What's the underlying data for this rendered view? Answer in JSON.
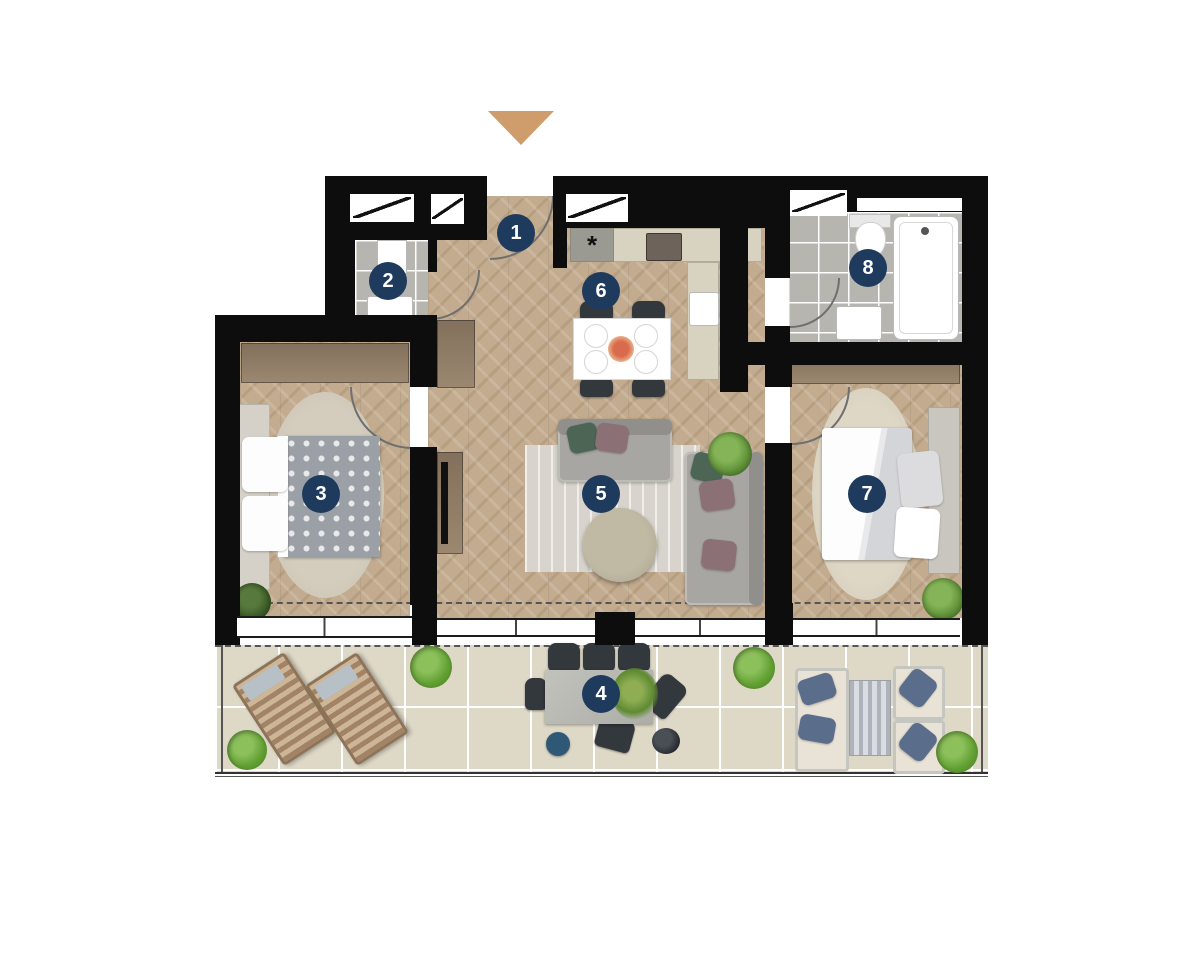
{
  "plan": {
    "entrance_arrow_icon": "triangle-down",
    "kitchen_marker": "*",
    "rooms": {
      "r1": {
        "label": "1"
      },
      "r2": {
        "label": "2"
      },
      "r3": {
        "label": "3"
      },
      "r4": {
        "label": "4"
      },
      "r5": {
        "label": "5"
      },
      "r6": {
        "label": "6"
      },
      "r7": {
        "label": "7"
      },
      "r8": {
        "label": "8"
      }
    },
    "colors": {
      "badge": "#1e3a5c",
      "arrow": "#cf9c6c",
      "walls": "#0d0d0d",
      "wood_floor": "#c2ab8e",
      "bath_tile": "#b7b5af",
      "terrace_tile": "#ded8c6"
    }
  }
}
